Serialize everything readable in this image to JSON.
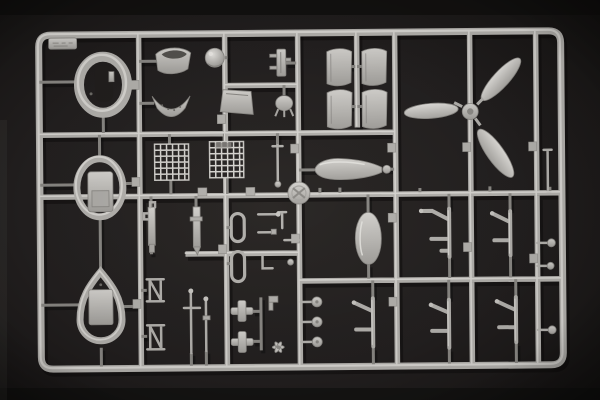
{
  "scene": {
    "type": "photograph",
    "subject": "Plastic model kit sprue with light grey aircraft parts on a dark charcoal background",
    "setting": "studio product photo, dark backdrop, soft top-left lighting",
    "sprue_material": "light grey injection-molded styrene"
  },
  "colors": {
    "background": "#262322",
    "background_edge": "#141211",
    "plastic": "#b4b2ae",
    "plastic_light": "#d8d6d2",
    "plastic_dark": "#8a8884",
    "part_fill_top": "#d5d3cf",
    "part_fill_bottom": "#a3a19d",
    "shadow": "#0b0a0a"
  },
  "sprue": {
    "shape": "rectangular runner frame with rounded corners, internal grid of runners",
    "grid": {
      "vertical_runners": 6,
      "horizontal_runners": 4
    },
    "id_tab": {
      "position": "top-left corner",
      "marking": "embossed, illegible"
    },
    "parts": [
      {
        "name": "engine-cowling-ring",
        "description": "oval cowling ring with open centre",
        "location": "top left"
      },
      {
        "name": "fuselage-bulkhead-ring",
        "description": "oval frame with rectangular plate inside",
        "location": "middle left"
      },
      {
        "name": "teardrop-frame",
        "description": "teardrop-shaped frame with plate inside",
        "location": "bottom left"
      },
      {
        "name": "intake-scoop",
        "description": "curved saddle scoop panel",
        "location": "top row"
      },
      {
        "name": "cowl-lip-section",
        "description": "perforated curved lip segment",
        "location": "top row"
      },
      {
        "name": "tail-wheel-ball",
        "description": "small spherical part",
        "location": "top row"
      },
      {
        "name": "equipment-bracket",
        "description": "slotted bracket with side pegs",
        "location": "top row"
      },
      {
        "name": "access-panel",
        "description": "trapezoid hatch panel",
        "location": "top row"
      },
      {
        "name": "engine-accessory",
        "description": "round part with mounting legs",
        "location": "top row"
      },
      {
        "name": "cowl-flap-set",
        "description": "four curved cowl-flap panels in two pairs",
        "location": "top centre-right"
      },
      {
        "name": "propeller",
        "description": "three-blade propeller with hub",
        "location": "top right"
      },
      {
        "name": "radiator-grille",
        "description": "two woven mesh grille screens",
        "location": "centre left"
      },
      {
        "name": "drop-tank-half",
        "description": "horizontal teardrop tank half",
        "location": "centre"
      },
      {
        "name": "runner-disc",
        "description": "embossed circular disc on runner junction",
        "location": "centre"
      },
      {
        "name": "oil-tank-half",
        "description": "vertical oval tank half",
        "location": "centre right"
      },
      {
        "name": "canopy-frame-loops",
        "description": "two small oblong ring frames",
        "location": "centre"
      },
      {
        "name": "cockpit-struts",
        "description": "two vertical struts with fittings",
        "location": "centre left"
      },
      {
        "name": "ladder-frames",
        "description": "two N-shaped brace frames",
        "location": "bottom left"
      },
      {
        "name": "control-rods",
        "description": "assorted tiny rods and fittings",
        "location": "centre"
      },
      {
        "name": "cross-fittings",
        "description": "two cross-shaped fittings",
        "location": "bottom centre"
      },
      {
        "name": "wheel-hub-pins",
        "description": "three round-headed pins",
        "location": "bottom centre"
      },
      {
        "name": "ventilator-fan",
        "description": "tiny three-blade fan",
        "location": "bottom centre"
      },
      {
        "name": "landing-gear-struts",
        "description": "five bent landing-gear legs",
        "location": "right half",
        "count": 5
      },
      {
        "name": "edge-pins",
        "description": "small round-headed pins along right margin",
        "location": "right edge"
      }
    ]
  }
}
